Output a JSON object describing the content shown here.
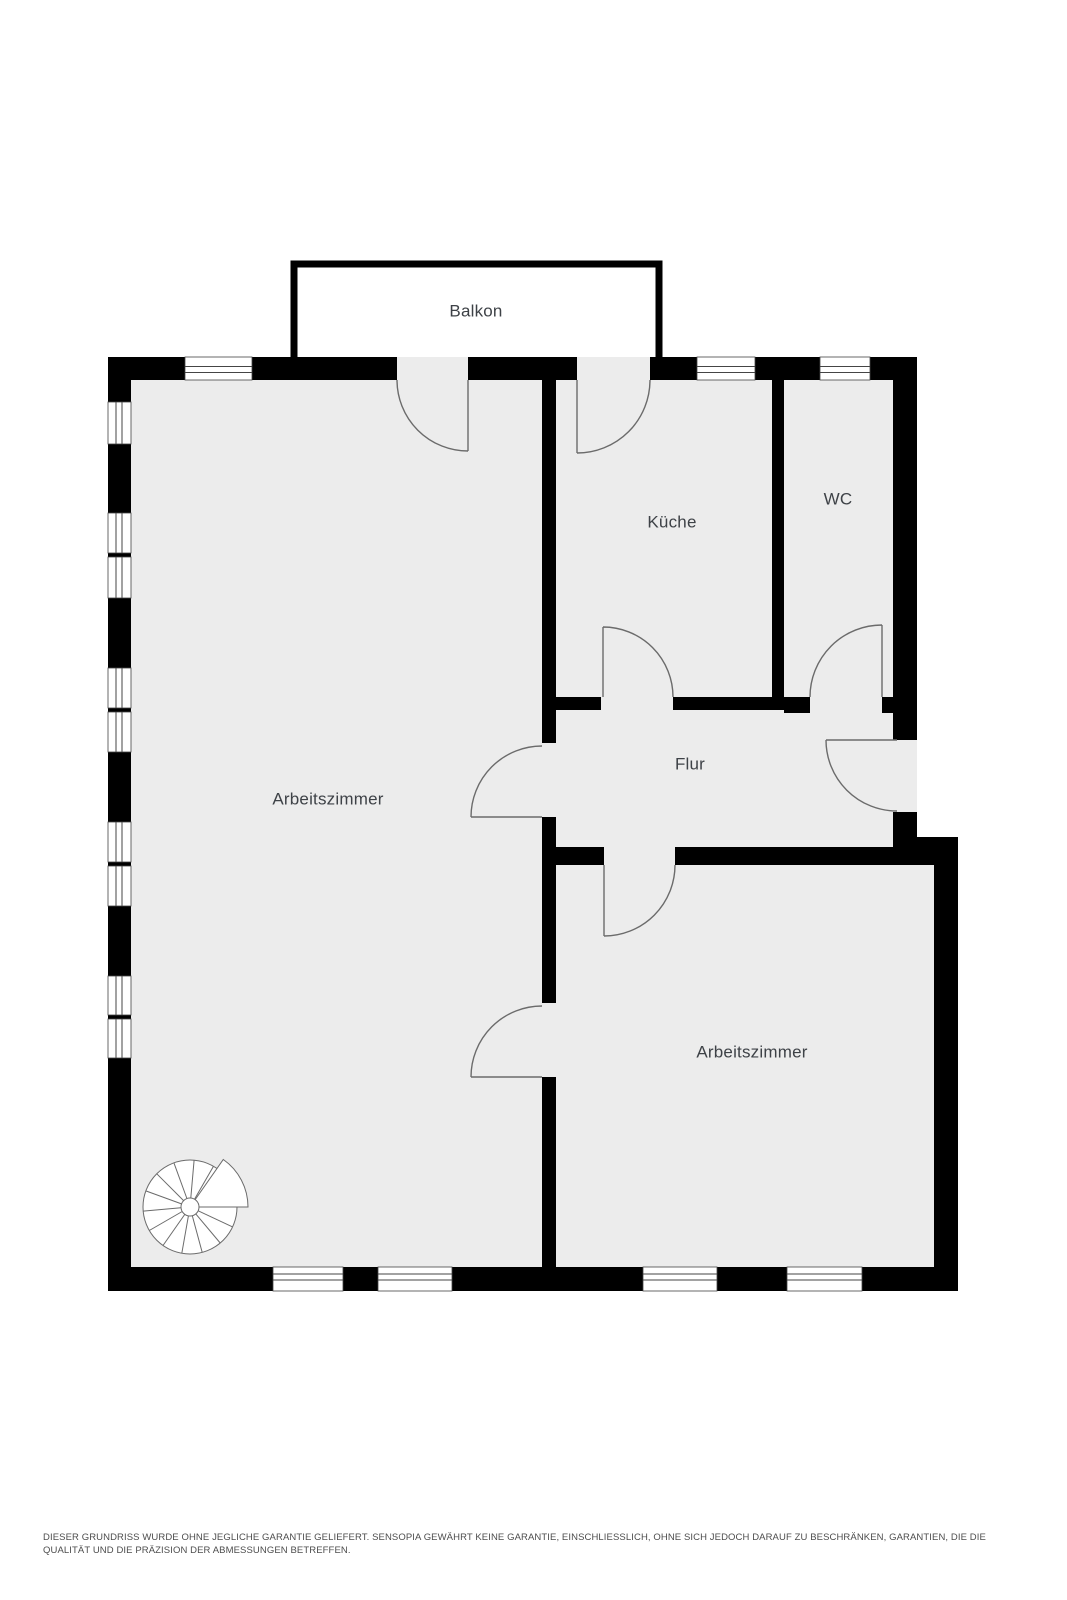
{
  "page": {
    "width": 1067,
    "height": 1600
  },
  "colors": {
    "page_bg": "#ffffff",
    "wall": "#000000",
    "floor": "#ececec",
    "door_line": "#6b6b6b",
    "window_line": "#454545",
    "label": "#3e4247",
    "disclaimer": "#4d4d4d"
  },
  "rooms": [
    {
      "id": "balkon",
      "label": "Balkon",
      "x": 476,
      "y": 312
    },
    {
      "id": "kueche",
      "label": "Küche",
      "x": 672,
      "y": 523
    },
    {
      "id": "wc",
      "label": "WC",
      "x": 838,
      "y": 500
    },
    {
      "id": "flur",
      "label": "Flur",
      "x": 690,
      "y": 765
    },
    {
      "id": "arbeitszimmer-1",
      "label": "Arbeitszimmer",
      "x": 328,
      "y": 800
    },
    {
      "id": "arbeitszimmer-2",
      "label": "Arbeitszimmer",
      "x": 752,
      "y": 1053
    }
  ],
  "disclaimer": {
    "line1": "DIESER GRUNDRISS WURDE OHNE JEGLICHE GARANTIE GELIEFERT. SENSOPIA GEWÄHRT KEINE GARANTIE, EINSCHLIESSLICH, OHNE SICH JEDOCH DARAUF ZU BESCHRÄNKEN, GARANTIEN, DIE DIE",
    "line2": "QUALITÄT UND DIE PRÄZISION DER ABMESSUNGEN BETREFFEN."
  }
}
